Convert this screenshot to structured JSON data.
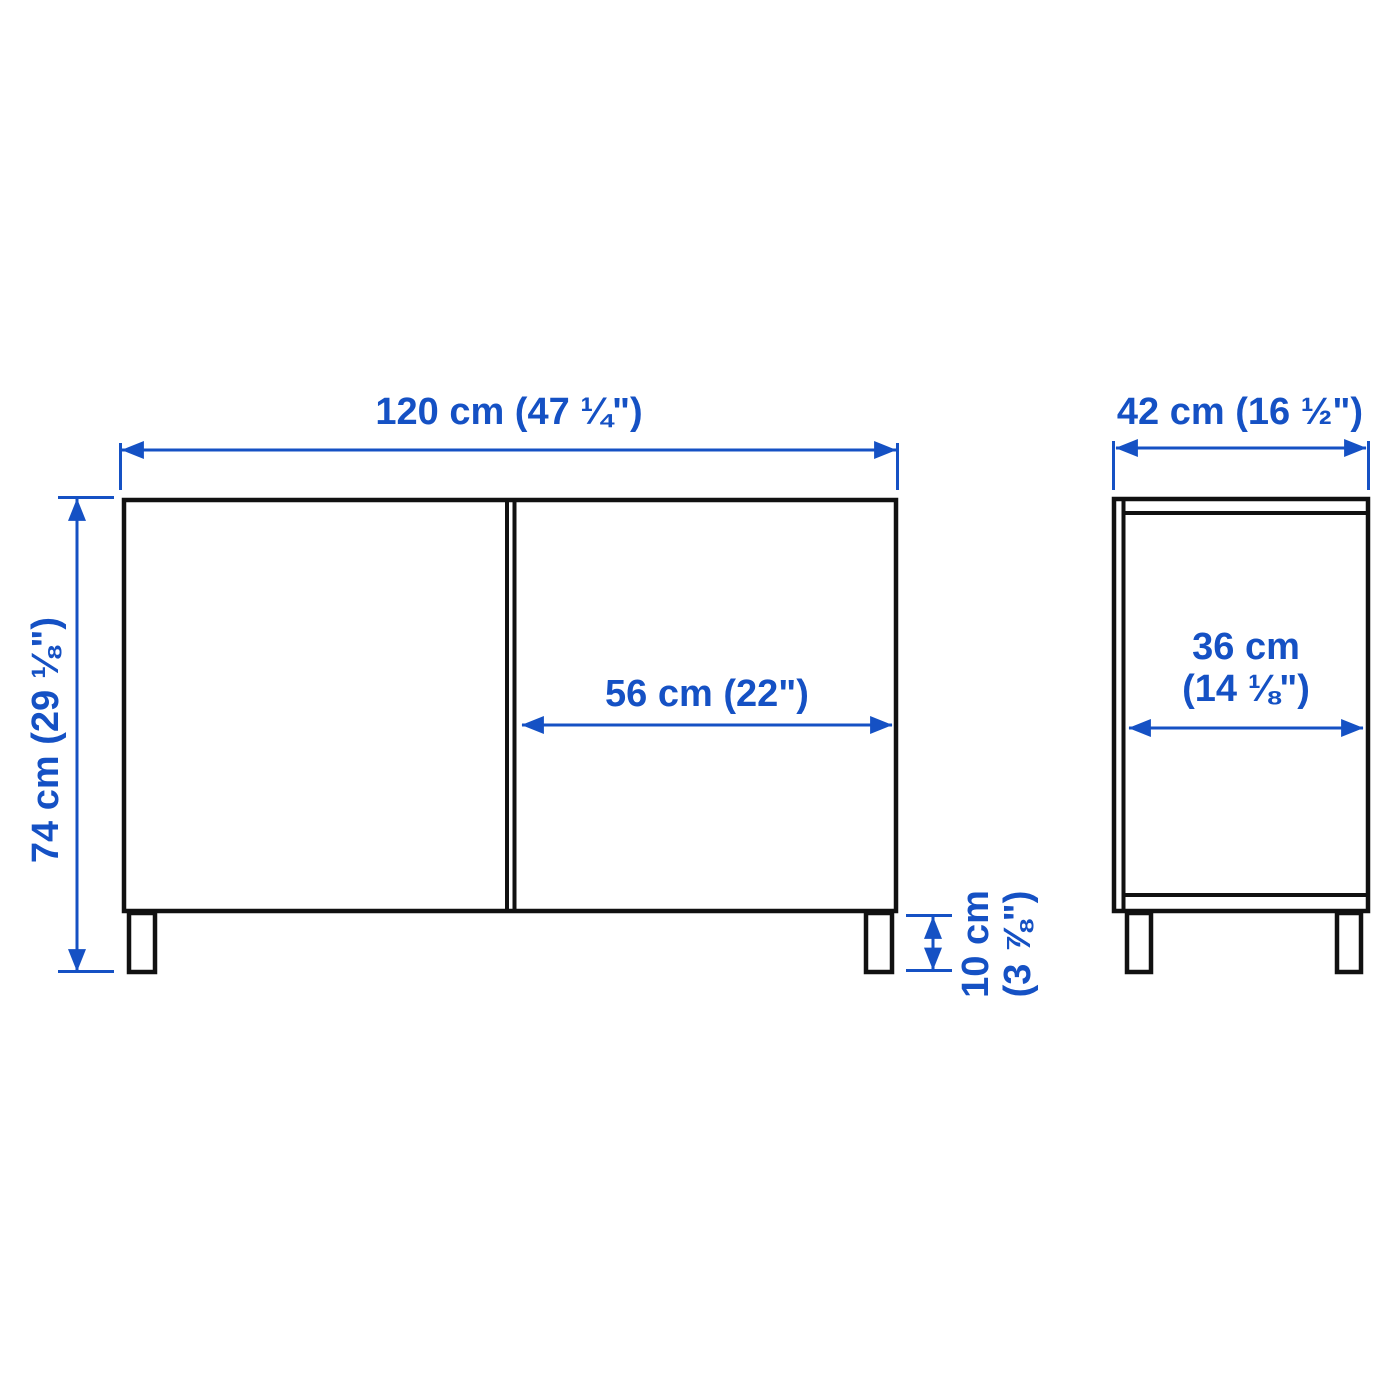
{
  "colors": {
    "dimension_blue": "#1551C4",
    "outline_black": "#111111",
    "background": "#ffffff"
  },
  "front_view": {
    "width_label": "120 cm (47 ¼\")",
    "height_label": "74 cm (29 ⅛\")",
    "door_width_label": "56 cm (22\")",
    "leg_height_label": [
      "10 cm",
      "(3 ⅞\")"
    ]
  },
  "side_view": {
    "depth_label": "42 cm (16 ½\")",
    "interior_depth_label": [
      "36 cm",
      "(14 ⅛\")"
    ]
  }
}
